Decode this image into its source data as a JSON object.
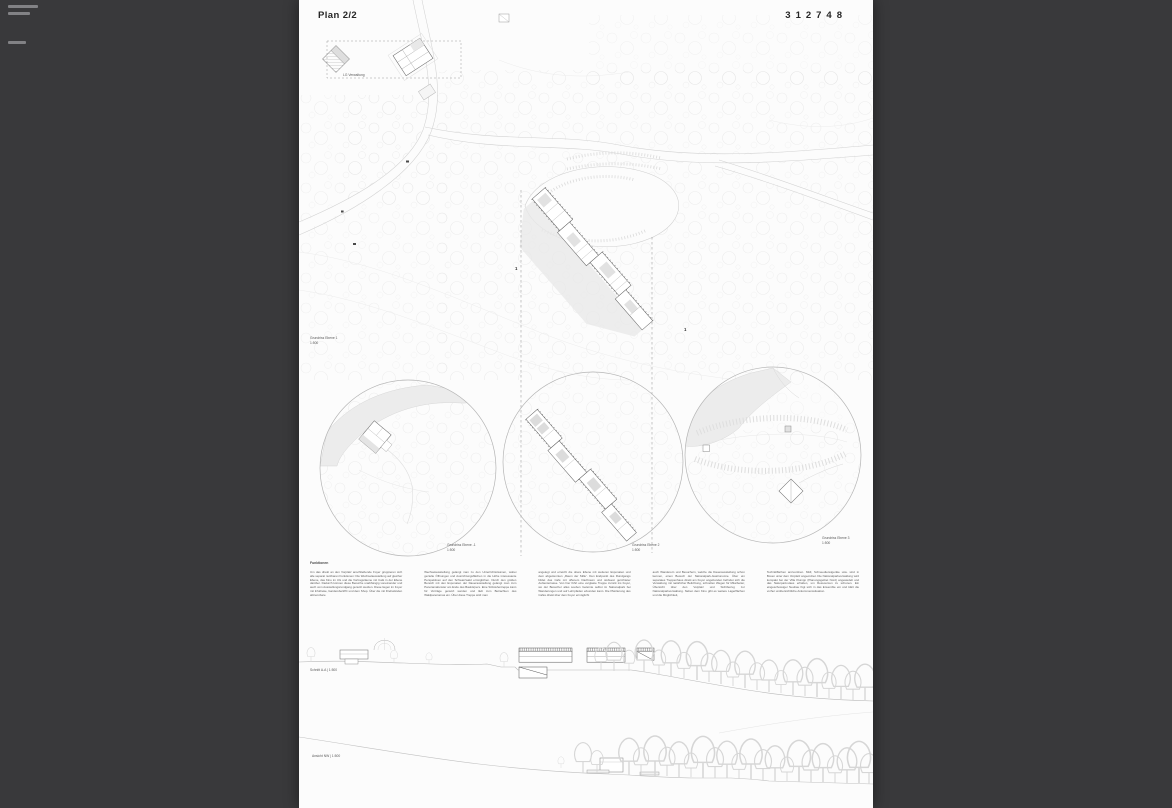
{
  "colors": {
    "background": "#39393b",
    "sheet": "#fcfcfc",
    "drawing_line": "#c9c9c9",
    "shadow_fill": "#e8e8e8",
    "text": "#5a5a5a"
  },
  "header": {
    "plan_label": "Plan 2/2",
    "entry_number": "312748"
  },
  "site_plan": {
    "title": "Grundriss Ebene 1",
    "scale": "1:500",
    "annotation_lg": "LG Verwaltung",
    "section_mark": "1"
  },
  "level_circles": [
    {
      "title": "Grundriss Ebene -1",
      "scale": "1:500"
    },
    {
      "title": "Grundriss Ebene 2",
      "scale": "1:500"
    },
    {
      "title": "Grundriss Ebene 3",
      "scale": "1:500"
    }
  ],
  "description": {
    "heading": "Funktionen",
    "columns": [
      "Um das direkt an den Vorplatz anschließende Foyer gruppieren sich alle separat nutzbaren Funktionen: Die Wechselausstellung auf gleicher Ebene, das Kino im UG und die Vortragsräume mit Café in der Ebene darüber. Dadurch können diese Bereiche unabhängig voneinander und auch vom Ausstellungsrundgang genutzt werden. Diese liegen im Foyer mit Infotheke, Garderobe/WC und dem Shop. Über die mit Drehwänden abtrennbare",
      "Wechselausstellung gelangt man zu den Unterrichtsräumen, wobei gezielte Öffnungen und Ausrichtungsflächen in die Höhe interessante Perspektiven auf den Schwarzwald ermöglichen. Durch den großen Bereich mit den Exponaten der Dauerausstellung gelangt man zum Panoramafenster am Ende des Baukörpers. Eine Sitzstufentreppe kann für Vorträge genutzt werden und lädt zum Betrachten des Waldpanoramas ein. Über diese Treppe wird man",
      "angelegt und erreicht die obere Ebene mit weiteren Exponaten und dem abgetrennten „Raum der Stille“. Den Endpunkt des Rundgangs bildet das Café mit offenem Dachraum und südwest gerichteter Außenterrasse. Von hier führt eine verglaste Treppe zurück ins Foyer, wo der Besucher alles soeben Gelernte selbst im Nationalpark bei Wanderungen und auf Lehrpfaden erkunden kann. Die Platzierung des Cafés direkt über dem Foyer ermöglicht",
      "auch Wanderern und Besuchern, welche die Dauerausstellung schon kennen, einen Besuch der Nationalpark-Gastronomie. Über ein separates Treppenhaus direkt am Foyer angebunden befindet sich die Verwaltung mit natürlicher Belichtung, schnellen Wegen für Mitarbeiter, Übersicht über den Vorplatz und Sichtbezug zur Nationalparkverwaltung. Neben dem Kino gibt es weitere Lagerflächen und die Möglichkeit,",
      "Technikflächen anzuordnen. Müll, Schneedienstgeräte usw. sind in Boxen unter dem Vorplatz angeordnet. Die Nationalparkverwaltung wird kompakt bei der Villa Klumpp (Planungsgebiet Nord) angesiedelt und das Naturpark-Haus erhalten, um Ressourcen zu schonen. Ein eingeschossiger Neubau fügt sich in das Ensemble ein und klärt die vorher unübersichtliche Ankommenssituation."
    ]
  },
  "section": {
    "label": "Schnitt A-A | 1:500"
  },
  "elevation": {
    "label": "Ansicht NW | 1:500"
  }
}
